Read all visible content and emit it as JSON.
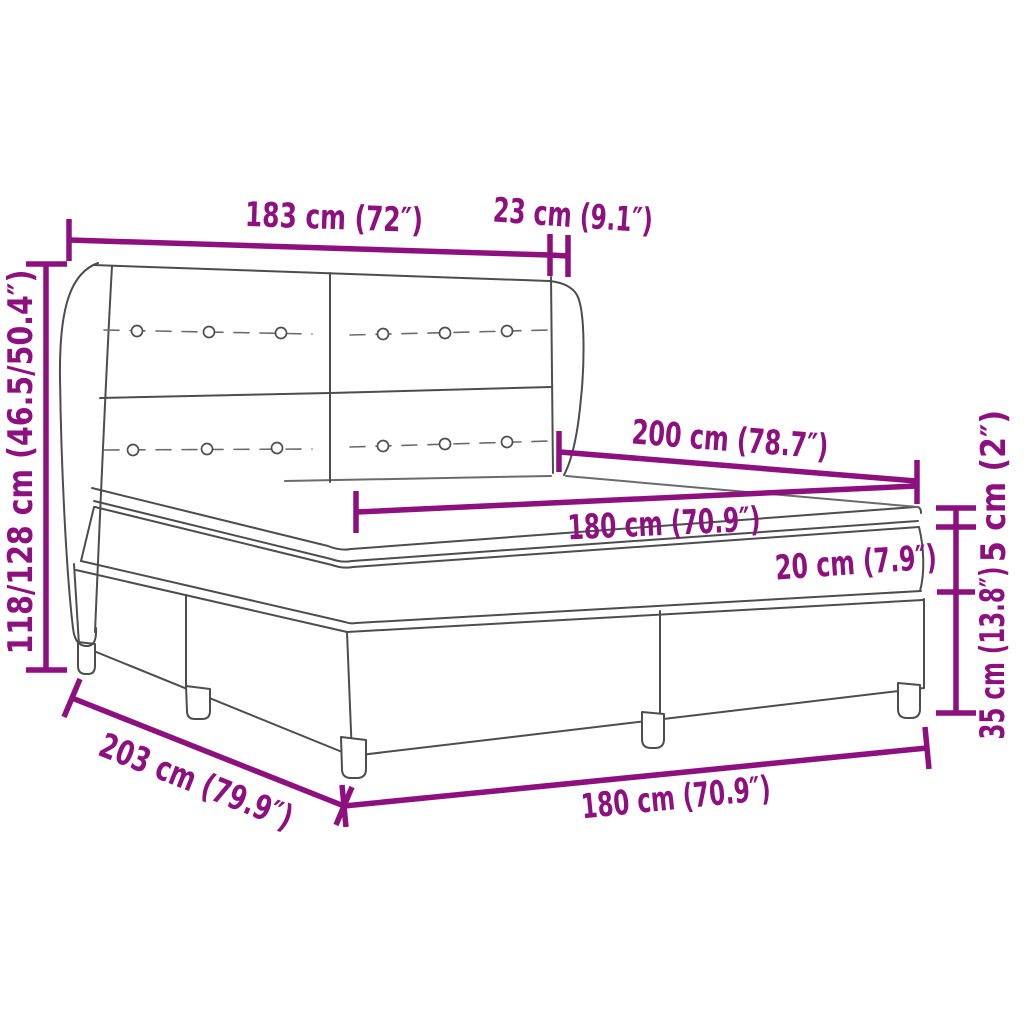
{
  "diagram": {
    "colors": {
      "dimension": "#8D107E",
      "outline": "#4d4d4d",
      "outline_light": "#6b6b6b",
      "background": "#ffffff"
    },
    "labels": {
      "headboard_width": "183 cm (72″)",
      "headboard_depth": "23 cm (9.1″)",
      "headboard_height": "118/128 cm (46.5/50.4″)",
      "mattress_length": "200 cm (78.7″)",
      "mattress_width_top": "180 cm (70.9″)",
      "topper_thickness": "5 cm (2″)",
      "mattress_thickness": "20 cm (7.9″)",
      "base_height": "35 cm (13.8″)",
      "bed_length": "203 cm (79.9″)",
      "bed_width_bottom": "180 cm (70.9″)"
    }
  }
}
